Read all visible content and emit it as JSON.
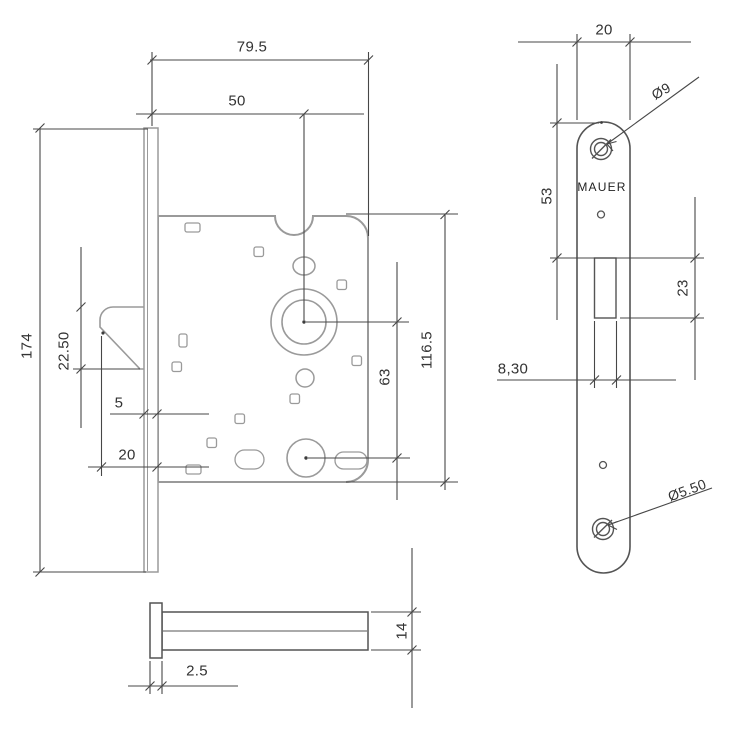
{
  "drawing_type": "mortise-lock technical drawing",
  "brand": "MAUER",
  "palette": {
    "part_light": "#9a9a9a",
    "part_dark": "#545454",
    "dim": "#474747",
    "text": "#333333"
  },
  "labels": {
    "case_depth": "79.5",
    "backset": "50",
    "forend_height": "174",
    "latch_height": "22.50",
    "forend_offset": "5",
    "latch_to_forend": "20",
    "axle_distance": "63",
    "case_height": "116.5",
    "forend_thickness": "2.5",
    "case_thickness": "14",
    "faceplate_width": "20",
    "screw_to_slot": "53",
    "slot_height": "23",
    "slot_width": "8,30",
    "top_hole_dia": "Ø9",
    "bottom_hole_dia": "Ø5.50",
    "brand": "MAUER"
  }
}
